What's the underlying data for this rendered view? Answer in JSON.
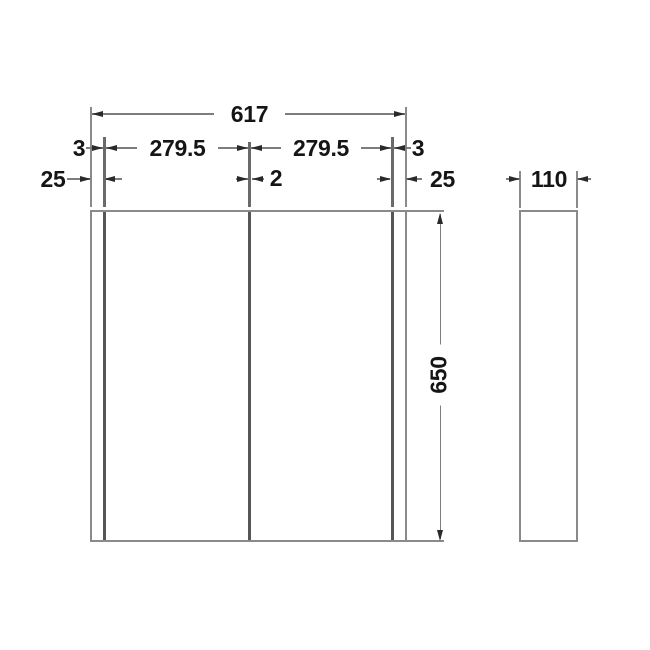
{
  "drawing": {
    "labels": {
      "total_width": "617",
      "left_reveal": "3",
      "left_door": "279.5",
      "right_door": "279.5",
      "right_reveal": "3",
      "left_offset": "25",
      "center_gap": "2",
      "right_offset": "25",
      "height": "650",
      "depth": "110"
    },
    "colors": {
      "outline": "#8a8a8a",
      "panel_line": "#565656",
      "dimension_line": "#7d7d7d",
      "arrow": "#2a2a2a",
      "text": "#151515",
      "background": "#ffffff"
    }
  }
}
